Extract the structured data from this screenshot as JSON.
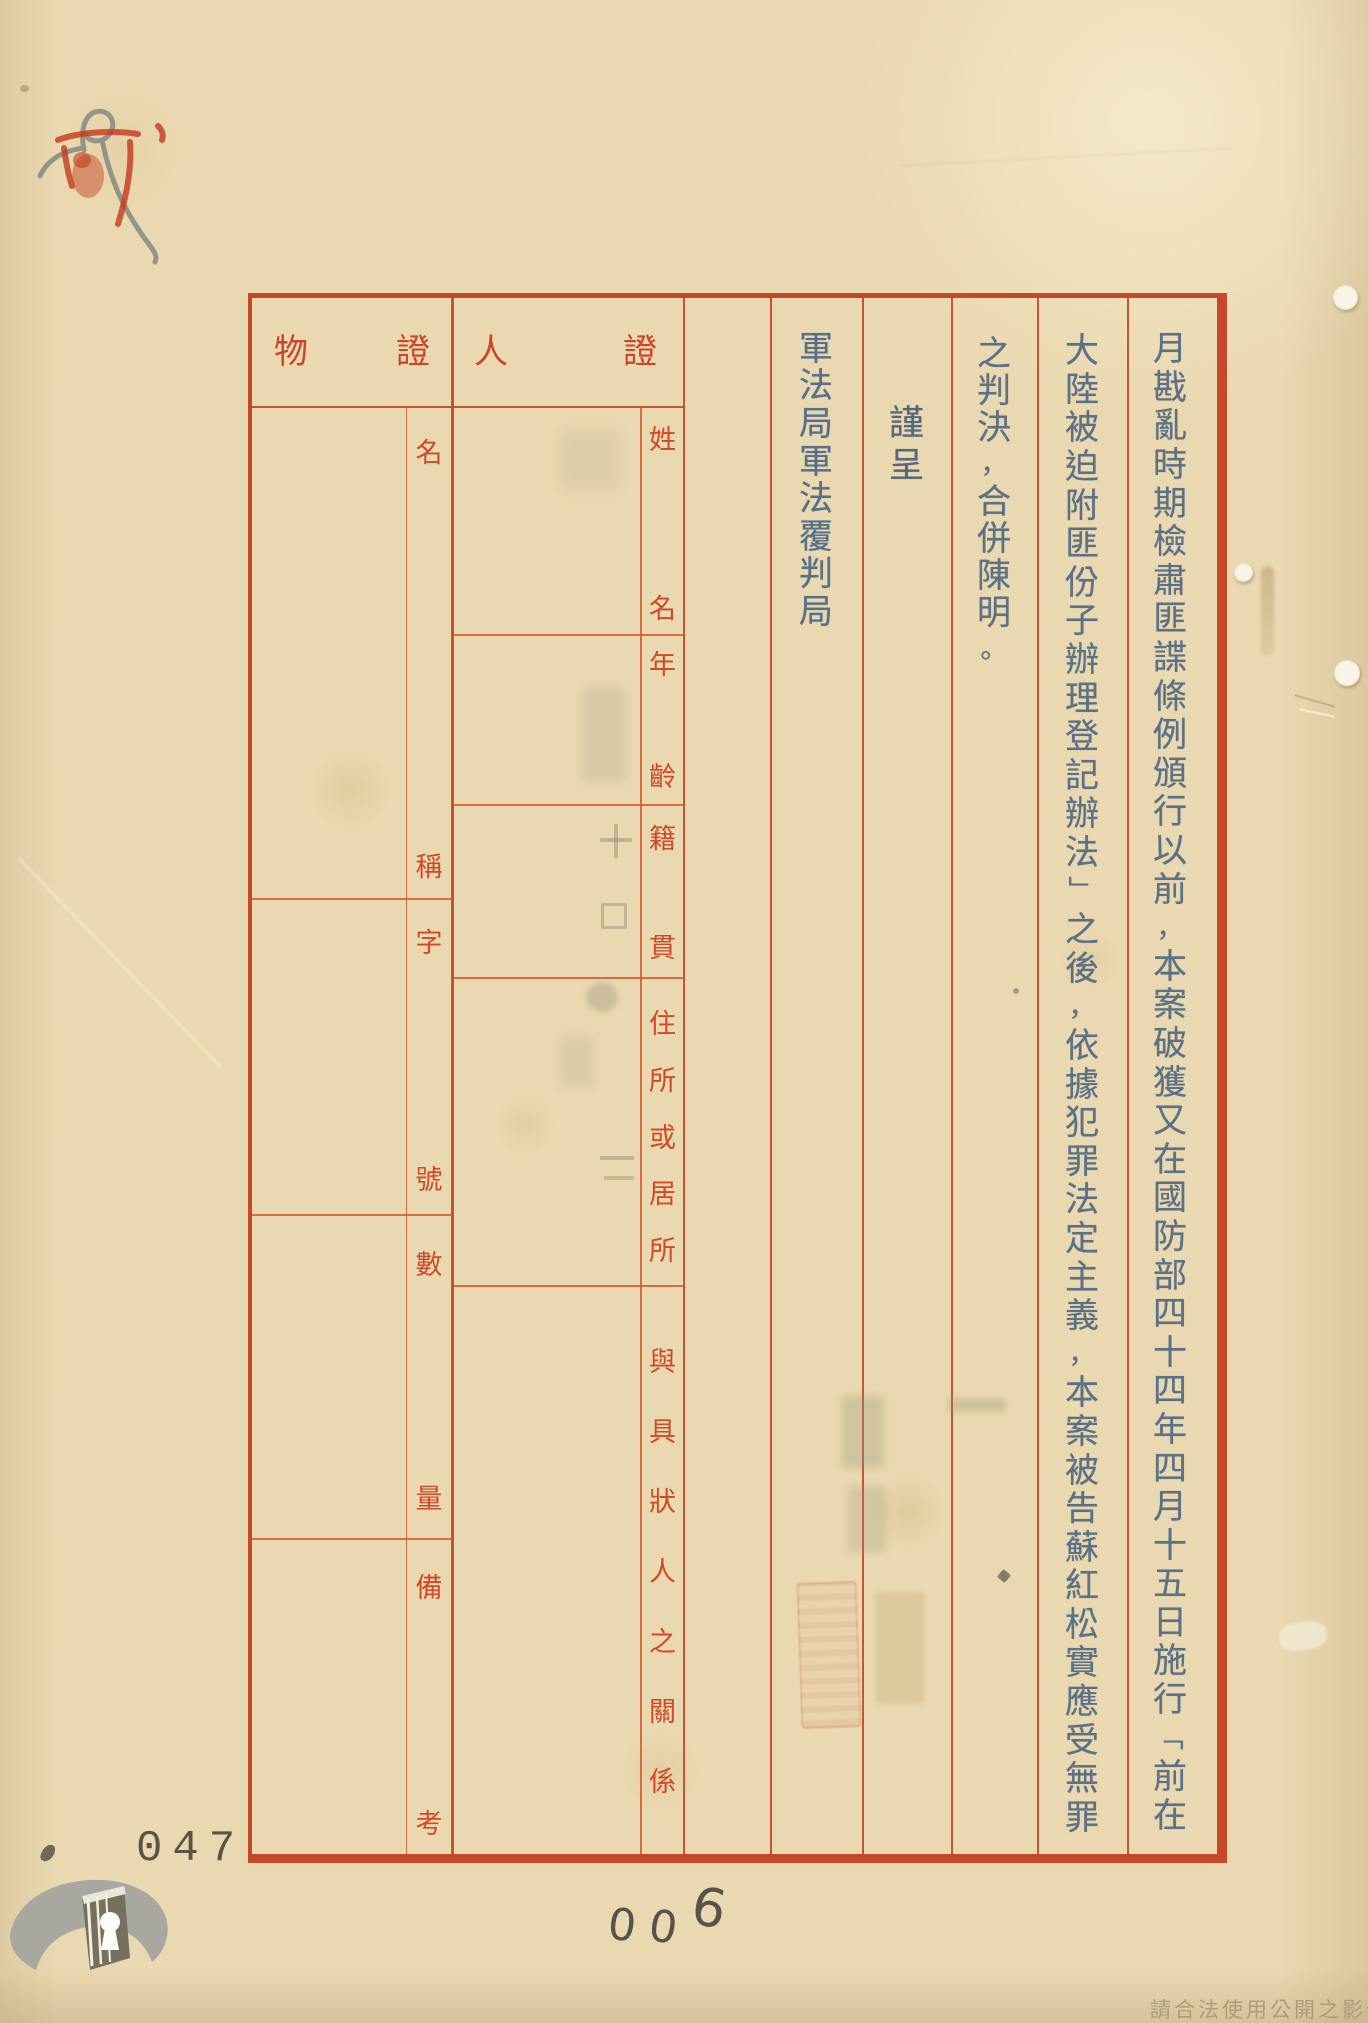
{
  "page": {
    "archive_number": "047",
    "pencil_number": "006",
    "watermark": "請合法使用公開之影像"
  },
  "form": {
    "headers": {
      "object_evidence": "物證",
      "person_evidence": "人證"
    },
    "object_labels": [
      "名稱",
      "字號",
      "數量",
      "備考"
    ],
    "person_labels": [
      "姓名",
      "年齡",
      "籍貫",
      "住所或居所",
      "與具狀人之關係"
    ],
    "body_columns": [
      {
        "id": "petition-line-1",
        "text": "月戡亂時期檢肅匪諜條例頒行以前，本案破獲又在國防部四十四年四月十五日施行「前在"
      },
      {
        "id": "petition-line-2",
        "text": "大陸被迫附匪份子辦理登記辦法」之後，依據犯罪法定主義，本案被告蘇紅松實應受無罪"
      },
      {
        "id": "petition-line-3",
        "text": "之判決，合併陳明。"
      },
      {
        "id": "salutation",
        "text": "謹呈"
      },
      {
        "id": "recipient",
        "text": "軍法局軍法覆判局"
      }
    ]
  },
  "icons": {
    "logo": "archives-book-logo",
    "top_left_marks": "red-seal-and-pencil-scribble",
    "holes": "punch-hole",
    "seal": "faint-red-seal-imprint"
  },
  "colors": {
    "paper": "#ead8b0",
    "form_red": "#c6482a",
    "label_red": "#cf4a28",
    "ink_blue": "#5b7186",
    "watermark_gray": "#a89879"
  }
}
